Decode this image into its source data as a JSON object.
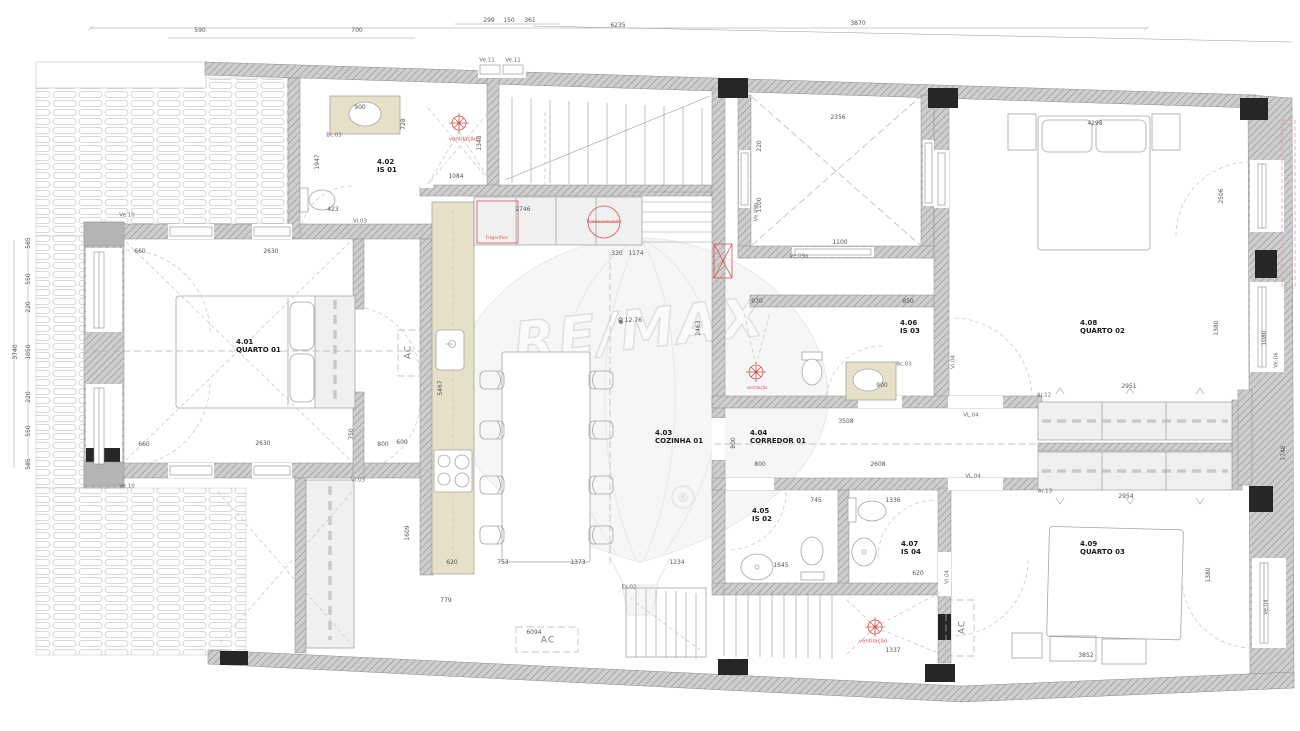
{
  "watermark": {
    "brand": "RE/MAX",
    "registered_symbol": "®"
  },
  "rooms": [
    {
      "id": "4.01",
      "name": "QUARTO 01",
      "x": 236,
      "y": 338
    },
    {
      "id": "4.02",
      "name": "IS 01",
      "x": 377,
      "y": 158
    },
    {
      "id": "4.03",
      "name": "COZINHA 01",
      "x": 655,
      "y": 429
    },
    {
      "id": "4.04",
      "name": "CORREDOR 01",
      "x": 750,
      "y": 429
    },
    {
      "id": "4.05",
      "name": "IS 02",
      "x": 752,
      "y": 507
    },
    {
      "id": "4.06",
      "name": "IS 03",
      "x": 900,
      "y": 319
    },
    {
      "id": "4.07",
      "name": "IS 04",
      "x": 901,
      "y": 540
    },
    {
      "id": "4.08",
      "name": "QUARTO 02",
      "x": 1080,
      "y": 319
    },
    {
      "id": "4.09",
      "name": "QUARTO 03",
      "x": 1080,
      "y": 540
    }
  ],
  "red_annotations": [
    {
      "text": "ventilação",
      "x": 463,
      "y": 140
    },
    {
      "text": "ventilação",
      "x": 757,
      "y": 388,
      "s": 4
    },
    {
      "text": "ventilação",
      "x": 873,
      "y": 642
    },
    {
      "text": "Frigorífico",
      "x": 497,
      "y": 239,
      "s": 4.5
    },
    {
      "text": "Termoacumulador",
      "x": 604,
      "y": 222,
      "s": 4
    }
  ],
  "ac_units": [
    {
      "text": "AC",
      "x": 409,
      "y": 352,
      "rot": true
    },
    {
      "text": "AC",
      "x": 548,
      "y": 641
    },
    {
      "text": "AC",
      "x": 963,
      "y": 627,
      "rot": true
    }
  ],
  "opening_labels": [
    {
      "text": "Ve.11",
      "x": 487,
      "y": 61
    },
    {
      "text": "Ve.11",
      "x": 513,
      "y": 61
    },
    {
      "text": "Ve.10",
      "x": 127,
      "y": 216
    },
    {
      "text": "Ve.10",
      "x": 127,
      "y": 487
    },
    {
      "text": "Vi.03",
      "x": 360,
      "y": 222
    },
    {
      "text": "Vi.03",
      "x": 358,
      "y": 481
    },
    {
      "text": "Vi.04",
      "x": 954,
      "y": 362,
      "rot": true
    },
    {
      "text": "Vi.04",
      "x": 948,
      "y": 577,
      "rot": true
    },
    {
      "text": "VL.04",
      "x": 971,
      "y": 416
    },
    {
      "text": "VL.04",
      "x": 973,
      "y": 477
    },
    {
      "text": "Ve.09b",
      "x": 757,
      "y": 212,
      "rot": true
    },
    {
      "text": "Ve.09a",
      "x": 799,
      "y": 257
    },
    {
      "text": "Ar.12",
      "x": 1044,
      "y": 396
    },
    {
      "text": "Ar.13",
      "x": 1045,
      "y": 492
    },
    {
      "text": "Es.02",
      "x": 629,
      "y": 588
    },
    {
      "text": "Bc.03",
      "x": 334,
      "y": 136
    },
    {
      "text": "Bc.03",
      "x": 904,
      "y": 365
    },
    {
      "text": "Ve.06",
      "x": 1277,
      "y": 360,
      "rot": true
    },
    {
      "text": "Ve.04",
      "x": 1267,
      "y": 607,
      "rot": true
    }
  ],
  "dimensions": [
    {
      "text": "6235",
      "x": 618,
      "y": 26
    },
    {
      "text": "299",
      "x": 489,
      "y": 21
    },
    {
      "text": "150",
      "x": 509,
      "y": 21
    },
    {
      "text": "361",
      "x": 530,
      "y": 21
    },
    {
      "text": "3870",
      "x": 858,
      "y": 24
    },
    {
      "text": "590",
      "x": 200,
      "y": 31
    },
    {
      "text": "700",
      "x": 357,
      "y": 31
    },
    {
      "text": "3740",
      "x": 16,
      "y": 352,
      "rot": true
    },
    {
      "text": "585",
      "x": 29,
      "y": 243,
      "rot": true
    },
    {
      "text": "550",
      "x": 29,
      "y": 279,
      "rot": true
    },
    {
      "text": "220",
      "x": 29,
      "y": 307,
      "rot": true
    },
    {
      "text": "1050",
      "x": 29,
      "y": 352,
      "rot": true
    },
    {
      "text": "220",
      "x": 29,
      "y": 397,
      "rot": true
    },
    {
      "text": "550",
      "x": 29,
      "y": 431,
      "rot": true
    },
    {
      "text": "585",
      "x": 29,
      "y": 464,
      "rot": true
    },
    {
      "text": "660",
      "x": 140,
      "y": 252
    },
    {
      "text": "2630",
      "x": 271,
      "y": 252
    },
    {
      "text": "660",
      "x": 144,
      "y": 445
    },
    {
      "text": "2630",
      "x": 263,
      "y": 444
    },
    {
      "text": "1947",
      "x": 318,
      "y": 162,
      "rot": true
    },
    {
      "text": "728",
      "x": 404,
      "y": 124,
      "rot": true
    },
    {
      "text": "900",
      "x": 360,
      "y": 108
    },
    {
      "text": "423",
      "x": 333,
      "y": 210
    },
    {
      "text": "1084",
      "x": 456,
      "y": 177
    },
    {
      "text": "1348",
      "x": 480,
      "y": 143,
      "rot": true
    },
    {
      "text": "2746",
      "x": 523,
      "y": 210
    },
    {
      "text": "5467",
      "x": 441,
      "y": 388,
      "rot": true
    },
    {
      "text": "750",
      "x": 352,
      "y": 434,
      "rot": true
    },
    {
      "text": "600",
      "x": 402,
      "y": 443
    },
    {
      "text": "800",
      "x": 383,
      "y": 445
    },
    {
      "text": "1609",
      "x": 408,
      "y": 533,
      "rot": true
    },
    {
      "text": "620",
      "x": 452,
      "y": 563
    },
    {
      "text": "753",
      "x": 503,
      "y": 563
    },
    {
      "text": "1373",
      "x": 578,
      "y": 563
    },
    {
      "text": "1234",
      "x": 677,
      "y": 563
    },
    {
      "text": "779",
      "x": 446,
      "y": 601
    },
    {
      "text": "6094",
      "x": 534,
      "y": 633
    },
    {
      "text": "330",
      "x": 617,
      "y": 254
    },
    {
      "text": "1174",
      "x": 636,
      "y": 254
    },
    {
      "text": "Ø 12.76",
      "x": 630,
      "y": 321
    },
    {
      "text": "2463",
      "x": 699,
      "y": 328,
      "rot": true
    },
    {
      "text": "2356",
      "x": 838,
      "y": 118
    },
    {
      "text": "1100",
      "x": 840,
      "y": 243
    },
    {
      "text": "220",
      "x": 760,
      "y": 146,
      "rot": true
    },
    {
      "text": "1100",
      "x": 760,
      "y": 205,
      "rot": true
    },
    {
      "text": "970",
      "x": 757,
      "y": 302
    },
    {
      "text": "850",
      "x": 908,
      "y": 302
    },
    {
      "text": "900",
      "x": 882,
      "y": 386
    },
    {
      "text": "3508",
      "x": 846,
      "y": 422
    },
    {
      "text": "800",
      "x": 760,
      "y": 465
    },
    {
      "text": "2608",
      "x": 878,
      "y": 465
    },
    {
      "text": "800",
      "x": 734,
      "y": 443,
      "rot": true
    },
    {
      "text": "745",
      "x": 816,
      "y": 501
    },
    {
      "text": "1336",
      "x": 893,
      "y": 501
    },
    {
      "text": "1645",
      "x": 781,
      "y": 566
    },
    {
      "text": "620",
      "x": 918,
      "y": 574
    },
    {
      "text": "1337",
      "x": 893,
      "y": 651
    },
    {
      "text": "3852",
      "x": 1086,
      "y": 656
    },
    {
      "text": "2954",
      "x": 1126,
      "y": 497
    },
    {
      "text": "2951",
      "x": 1129,
      "y": 387
    },
    {
      "text": "4298",
      "x": 1095,
      "y": 124
    },
    {
      "text": "2506",
      "x": 1222,
      "y": 196,
      "rot": true
    },
    {
      "text": "1380",
      "x": 1217,
      "y": 328,
      "rot": true
    },
    {
      "text": "1080",
      "x": 1265,
      "y": 338,
      "rot": true
    },
    {
      "text": "1748",
      "x": 1284,
      "y": 453,
      "rot": true
    },
    {
      "text": "1380",
      "x": 1209,
      "y": 575,
      "rot": true
    }
  ]
}
